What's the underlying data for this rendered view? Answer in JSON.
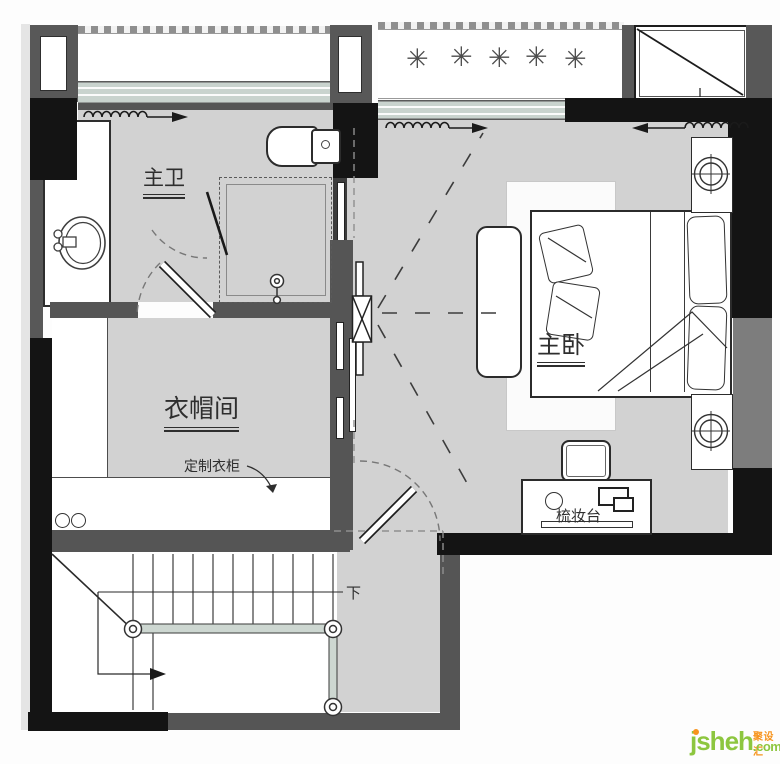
{
  "rooms": {
    "master_bath": {
      "label": "主卫"
    },
    "master_bedroom": {
      "label": "主卧"
    },
    "cloakroom": {
      "label": "衣帽间"
    }
  },
  "annotations": {
    "custom_wardrobe": {
      "label": "定制衣柜"
    },
    "dressing_table": {
      "label": "梳妆台"
    },
    "stair_down": {
      "label": "下"
    }
  },
  "icons": {
    "plant": "✳"
  },
  "watermark": {
    "name": "jsheh",
    "chinese": "聚设汇",
    "domain": ".com"
  },
  "colors": {
    "floor": "#d2d2d2",
    "wall_black": "#141414",
    "wall_gray": "#585858",
    "window_sill": "#c9d3ce",
    "railing": "#cdd7d1",
    "logo_green": "#8dc63f",
    "logo_orange": "#f7941d"
  }
}
